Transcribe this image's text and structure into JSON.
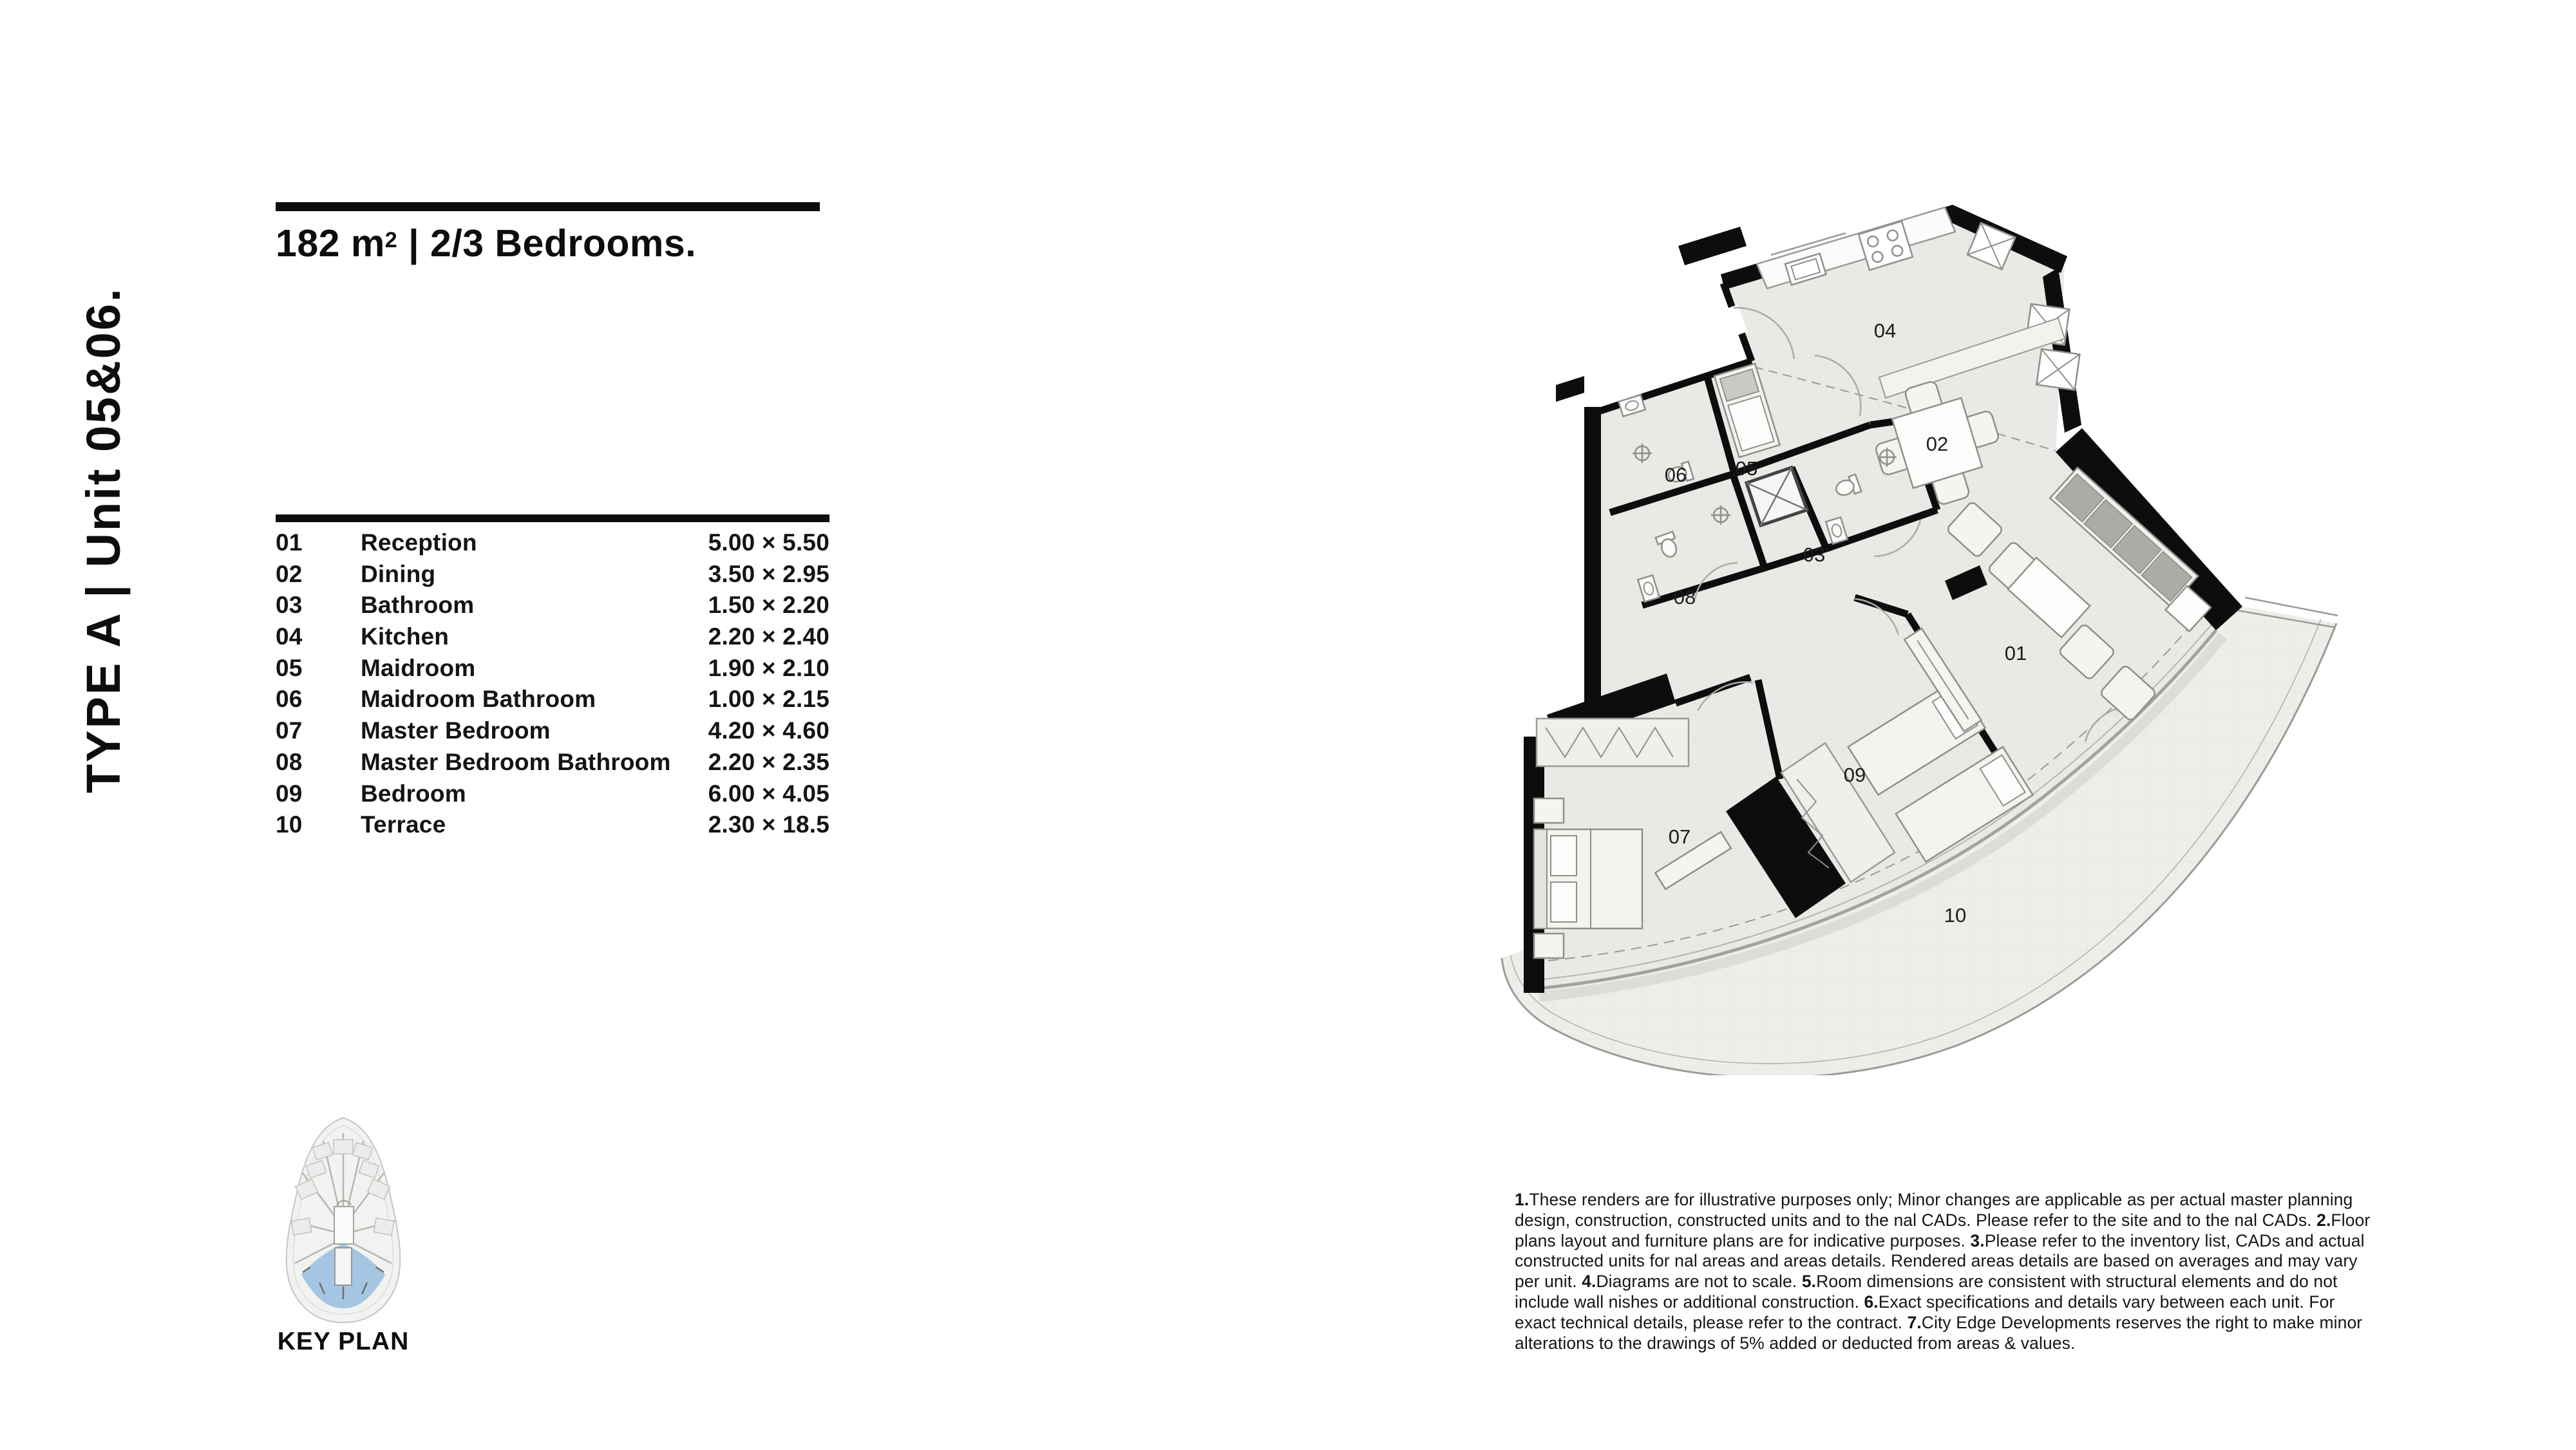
{
  "page": {
    "background": "#ffffff"
  },
  "sidebar": {
    "vertical_title": "TYPE A | Unit 05&06."
  },
  "header": {
    "area_value": "182 m",
    "area_sup": "2",
    "rest": " | 2/3 Bedrooms."
  },
  "room_table": {
    "rows": [
      {
        "num": "01",
        "name": "Reception",
        "dims": "5.00 × 5.50"
      },
      {
        "num": "02",
        "name": "Dining",
        "dims": "3.50 × 2.95"
      },
      {
        "num": "03",
        "name": "Bathroom",
        "dims": "1.50 × 2.20"
      },
      {
        "num": "04",
        "name": "Kitchen",
        "dims": "2.20 × 2.40"
      },
      {
        "num": "05",
        "name": "Maidroom",
        "dims": "1.90 × 2.10"
      },
      {
        "num": "06",
        "name": "Maidroom Bathroom",
        "dims": "1.00 × 2.15"
      },
      {
        "num": "07",
        "name": "Master Bedroom",
        "dims": "4.20 × 4.60"
      },
      {
        "num": "08",
        "name": "Master Bedroom Bathroom",
        "dims": "2.20 × 2.35"
      },
      {
        "num": "09",
        "name": "Bedroom",
        "dims": "6.00 × 4.05"
      },
      {
        "num": "10",
        "name": "Terrace",
        "dims": "2.30 × 18.5"
      }
    ]
  },
  "floor_plan": {
    "labels": [
      "01",
      "02",
      "03",
      "04",
      "05",
      "06",
      "07",
      "08",
      "09",
      "10"
    ]
  },
  "key_plan": {
    "label": "KEY PLAN",
    "highlight_color": "#a5c6e3"
  },
  "disclaimer": {
    "items": [
      {
        "num": "1.",
        "text": "These renders are for illustrative purposes only; Minor changes are applicable as per actual master planning design, construction, constructed units and to the nal CADs. Please refer to the site and to the nal CADs. "
      },
      {
        "num": "2.",
        "text": "Floor plans layout and furniture plans are for indicative purposes. "
      },
      {
        "num": "3.",
        "text": "Please refer to the inventory list, CADs and actual constructed units for nal areas and areas details. Rendered areas details are based on averages and may vary per unit. "
      },
      {
        "num": "4.",
        "text": "Diagrams are not to scale. "
      },
      {
        "num": "5.",
        "text": "Room dimensions are consistent with structural elements and do not include wall nishes or additional construction. "
      },
      {
        "num": "6.",
        "text": "Exact specifications and details vary between each unit. For exact technical details, please refer to the contract. "
      },
      {
        "num": "7.",
        "text": "City Edge Developments reserves the right to make minor alterations to the drawings of 5% added or deducted from areas & values."
      }
    ]
  },
  "colors": {
    "wall": "#0d0d0d",
    "floor": "#e9e9e6",
    "terrace": "#ededea",
    "outline": "#9b9b98",
    "keyplan_highlight": "#a5c6e3"
  }
}
